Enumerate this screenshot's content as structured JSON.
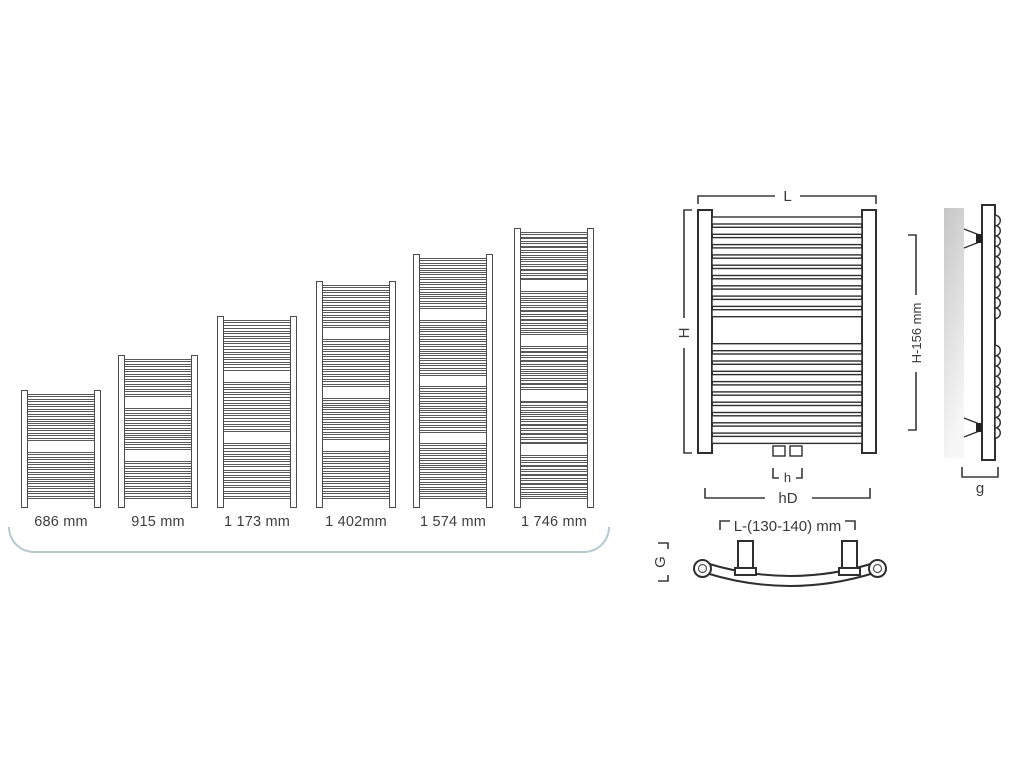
{
  "size_overview": {
    "items": [
      {
        "label": "686 mm",
        "height_mm": 686,
        "rung_groups": [
          10,
          10
        ]
      },
      {
        "label": "915 mm",
        "height_mm": 915,
        "rung_groups": [
          8,
          9,
          8
        ]
      },
      {
        "label": "1 173 mm",
        "height_mm": 1173,
        "rung_groups": [
          10,
          10,
          11
        ]
      },
      {
        "label": "1 402mm",
        "height_mm": 1402,
        "rung_groups": [
          9,
          10,
          9,
          10
        ]
      },
      {
        "label": "1 574 mm",
        "height_mm": 1574,
        "rung_groups": [
          11,
          12,
          10,
          12
        ]
      },
      {
        "label": "1 746 mm",
        "height_mm": 1746,
        "rung_groups": [
          11,
          10,
          10,
          10,
          10
        ]
      }
    ]
  },
  "diagram": {
    "front_view": {
      "rung_groups": [
        10,
        10
      ],
      "labels": {
        "width": "L",
        "height": "H",
        "connection_spacing": "h",
        "overall_width": "hD"
      }
    },
    "side_view": {
      "bump_groups": [
        10,
        9
      ],
      "labels": {
        "bracket_height": "H-156 mm",
        "depth": "g"
      }
    },
    "top_view": {
      "labels": {
        "bracket_spacing": "L-(130-140) mm",
        "curve_depth": "G"
      }
    }
  },
  "colors": {
    "line": "#2f2f2f",
    "dimension": "#3a3a3a",
    "underline": "#b6c9ce",
    "wall_dark": "#c6c6c6",
    "wall_light": "#f7f7f7"
  }
}
